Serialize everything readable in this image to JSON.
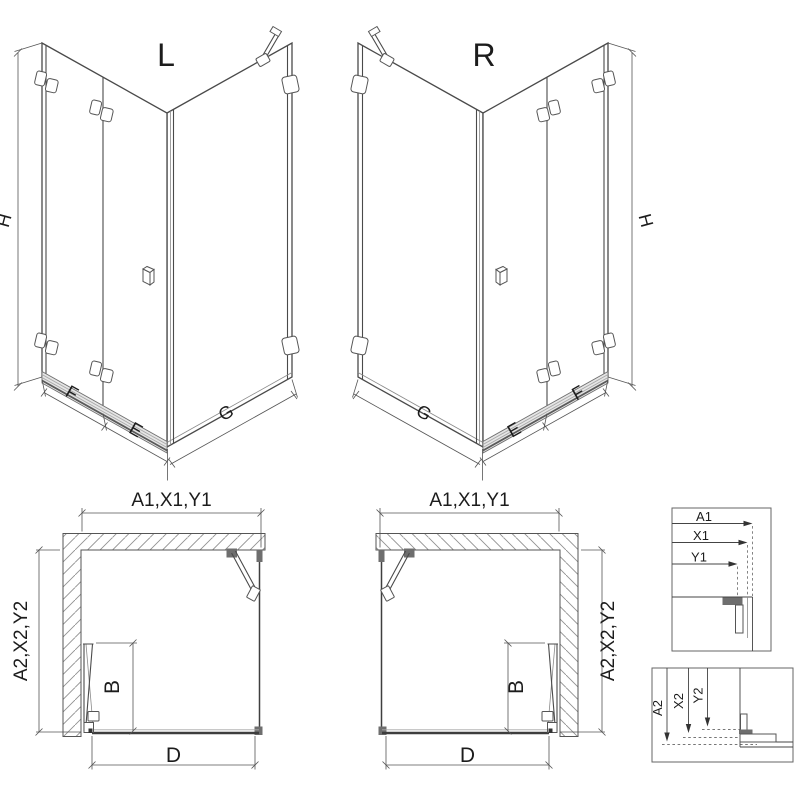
{
  "page": {
    "background": "#ffffff",
    "line_color": "#4a4a4a",
    "dimension_color": "#555555",
    "hatch_color": "#909090",
    "sill_color": "#9a9a9a",
    "text_color": "#1c1c1c"
  },
  "views": {
    "iso_left": {
      "title": "L",
      "dim_height": "H",
      "dim_door_panel": "F",
      "dim_fixed_panel": "E",
      "dim_side_panel": "G"
    },
    "iso_right": {
      "title": "R",
      "dim_height": "H",
      "dim_door_panel": "F",
      "dim_fixed_panel": "E",
      "dim_side_panel": "G"
    },
    "plan_left": {
      "dim_width": "A1,X1,Y1",
      "dim_depth": "A2,X2,Y2",
      "dim_door_reach": "B",
      "dim_entry": "D"
    },
    "plan_right": {
      "dim_width": "A1,X1,Y1",
      "dim_depth": "A2,X2,Y2",
      "dim_door_reach": "B",
      "dim_entry": "D"
    },
    "detail_width": {
      "labels": [
        "A1",
        "X1",
        "Y1"
      ]
    },
    "detail_depth": {
      "labels": [
        "A2",
        "X2",
        "Y2"
      ]
    }
  }
}
